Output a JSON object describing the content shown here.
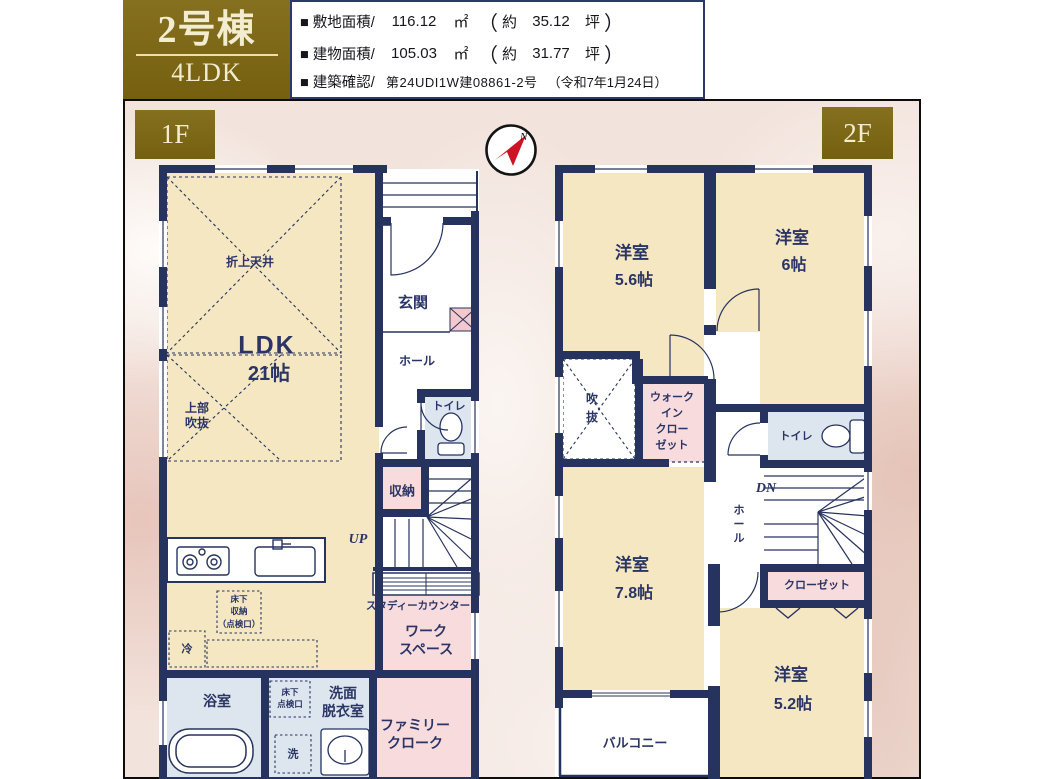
{
  "header": {
    "building_no": "2号棟",
    "layout": "4LDK",
    "specs": {
      "land_label": "■ 敷地面積/",
      "land_value": "116.12",
      "land_unit": "㎡",
      "paren_open": "（",
      "approx": "約",
      "land_tsubo": "35.12",
      "tsubo_unit": "坪",
      "paren_close": "）",
      "bldg_label": "■ 建物面積/",
      "bldg_value": "105.03",
      "bldg_unit": "㎡",
      "bldg_tsubo": "31.77",
      "confirm_label": "■ 建築確認/",
      "confirm_value": "第24UDI1W建08861-2号",
      "confirm_date": "（令和7年1月24日）"
    }
  },
  "compass": {
    "north": "N"
  },
  "floor1": {
    "tag": "1F",
    "ldk": "LDK",
    "ldk_size": "21帖",
    "coffered_ceiling": "折上天井",
    "void_above": [
      "上部",
      "吹抜"
    ],
    "entrance": "玄関",
    "hall": "ホール",
    "toilet": "トイレ",
    "storage": "収納",
    "up": "UP",
    "study_counter": "スタディーカウンター",
    "workspace": [
      "ワーク",
      "スペース"
    ],
    "underfloor_storage": [
      "床下",
      "収納",
      "（点検口）"
    ],
    "fridge": "冷",
    "bathroom": "浴室",
    "underfloor_access": [
      "床下",
      "点検口"
    ],
    "washroom": [
      "洗面",
      "脱衣室"
    ],
    "washer": "洗",
    "family_cloak": [
      "ファミリー",
      "クローク"
    ]
  },
  "floor2": {
    "tag": "2F",
    "room56": "洋室",
    "room56_size": "5.6帖",
    "room6": "洋室",
    "room6_size": "6帖",
    "void": [
      "吹",
      "抜"
    ],
    "wic": [
      "ウォーク",
      "イン",
      "クロー",
      "ゼット"
    ],
    "toilet": "トイレ",
    "dn": "DN",
    "hall": [
      "ホ",
      "ー",
      "ル"
    ],
    "closet": "クローゼット",
    "room78": "洋室",
    "room78_size": "7.8帖",
    "room52": "洋室",
    "room52_size": "5.2帖",
    "balcony": "バルコニー"
  },
  "colors": {
    "wall_navy": "#27335f",
    "room_cream": "#f6e7c3",
    "room_pink": "#f8dbdc",
    "room_blue": "#dde6ef",
    "tag_gold": "#7d6816",
    "north_red": "#cf1126"
  }
}
